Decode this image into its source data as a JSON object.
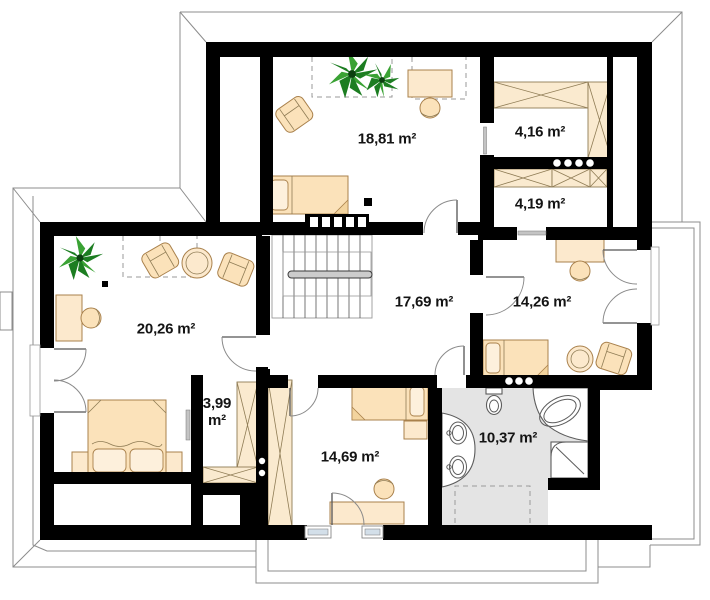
{
  "plan_title": "Floor plan",
  "colors": {
    "wall": "#000000",
    "furniture_fill": "#fbe2ba",
    "furniture_stroke": "#a9814c",
    "wardrobe_fill": "#faeacf",
    "bathroom_floor": "#e4e4e4",
    "plant_green_dark": "#1c7d21",
    "plant_green_light": "#3aa234",
    "outline_gray": "#8c8c8c",
    "label_color": "#141414",
    "glazing": "#d3dfe9"
  },
  "rooms": [
    {
      "id": "room-18-81",
      "area_label": "18,81 m²"
    },
    {
      "id": "closet-4-16",
      "area_label": "4,16 m²"
    },
    {
      "id": "closet-4-19",
      "area_label": "4,19 m²"
    },
    {
      "id": "hall-17-69",
      "area_label": "17,69 m²"
    },
    {
      "id": "room-14-26",
      "area_label": "14,26 m²"
    },
    {
      "id": "room-20-26",
      "area_label": "20,26 m²"
    },
    {
      "id": "wardrobe-3-99",
      "area_label": "3,99 m²"
    },
    {
      "id": "room-14-69",
      "area_label": "14,69 m²"
    },
    {
      "id": "bathroom-10-37",
      "area_label": "10,37 m²"
    }
  ],
  "icons": [
    "plant-icon",
    "armchair-icon",
    "round-table-icon",
    "desk-icon",
    "office-chair-icon",
    "single-bed-icon",
    "double-bed-icon",
    "nightstand-icon",
    "wardrobe-icon",
    "staircase-icon",
    "handrail-icon",
    "balustrade-icon",
    "door-swing-icon",
    "window-icon",
    "toilet-icon",
    "corner-bathtub-icon",
    "shower-icon",
    "washbasin-icon",
    "roof-outline-icon",
    "balcony-icon",
    "terrace-icon",
    "chimney-icon"
  ]
}
